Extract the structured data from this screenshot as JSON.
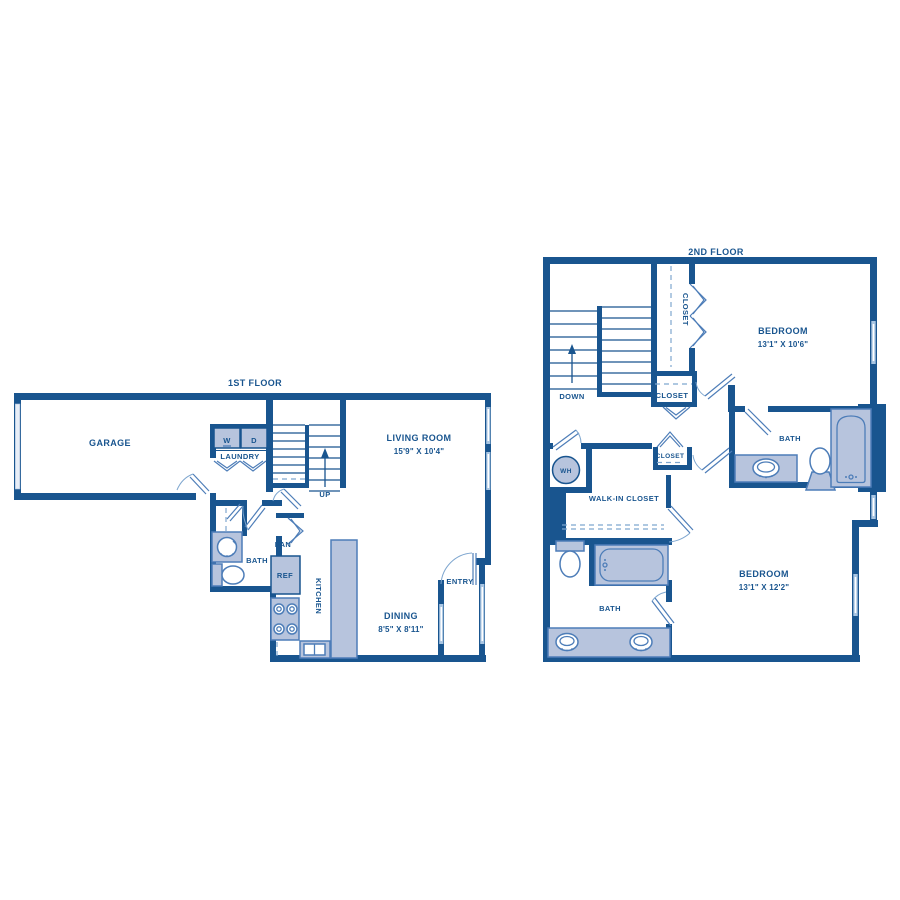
{
  "title": "Two-story apartment floor plan",
  "colors": {
    "wall": "#19558f",
    "fixture_stroke": "#4d7db8",
    "fixture_fill": "#b7c4dd",
    "window_fill": "#a9c6e3",
    "door_arc": "#7ea6cf",
    "garage_door": "#e8eef7"
  },
  "floor1": {
    "title": "1ST FLOOR",
    "garage": "GARAGE",
    "washer": "W",
    "dryer": "D",
    "laundry": "LAUNDRY",
    "living_room": "LIVING ROOM",
    "living_room_dim": "15'9\" X 10'4\"",
    "up": "UP",
    "bath": "BATH",
    "pantry": "PAN",
    "fridge": "REF",
    "kitchen": "KITCHEN",
    "dining": "DINING",
    "dining_dim": "8'5\" X 8'11\"",
    "entry": "ENTRY"
  },
  "floor2": {
    "title": "2ND FLOOR",
    "down": "DOWN",
    "closet_tall": "CLOSET",
    "closet_small": "CLOSET",
    "closet_mid": "CLOSET",
    "bedroom1": "BEDROOM",
    "bedroom1_dim": "13'1\" X 10'6\"",
    "bath1": "BATH",
    "water_heater": "WH",
    "walk_in": "WALK-IN CLOSET",
    "bath2": "BATH",
    "bedroom2": "BEDROOM",
    "bedroom2_dim": "13'1\" X 12'2\""
  }
}
